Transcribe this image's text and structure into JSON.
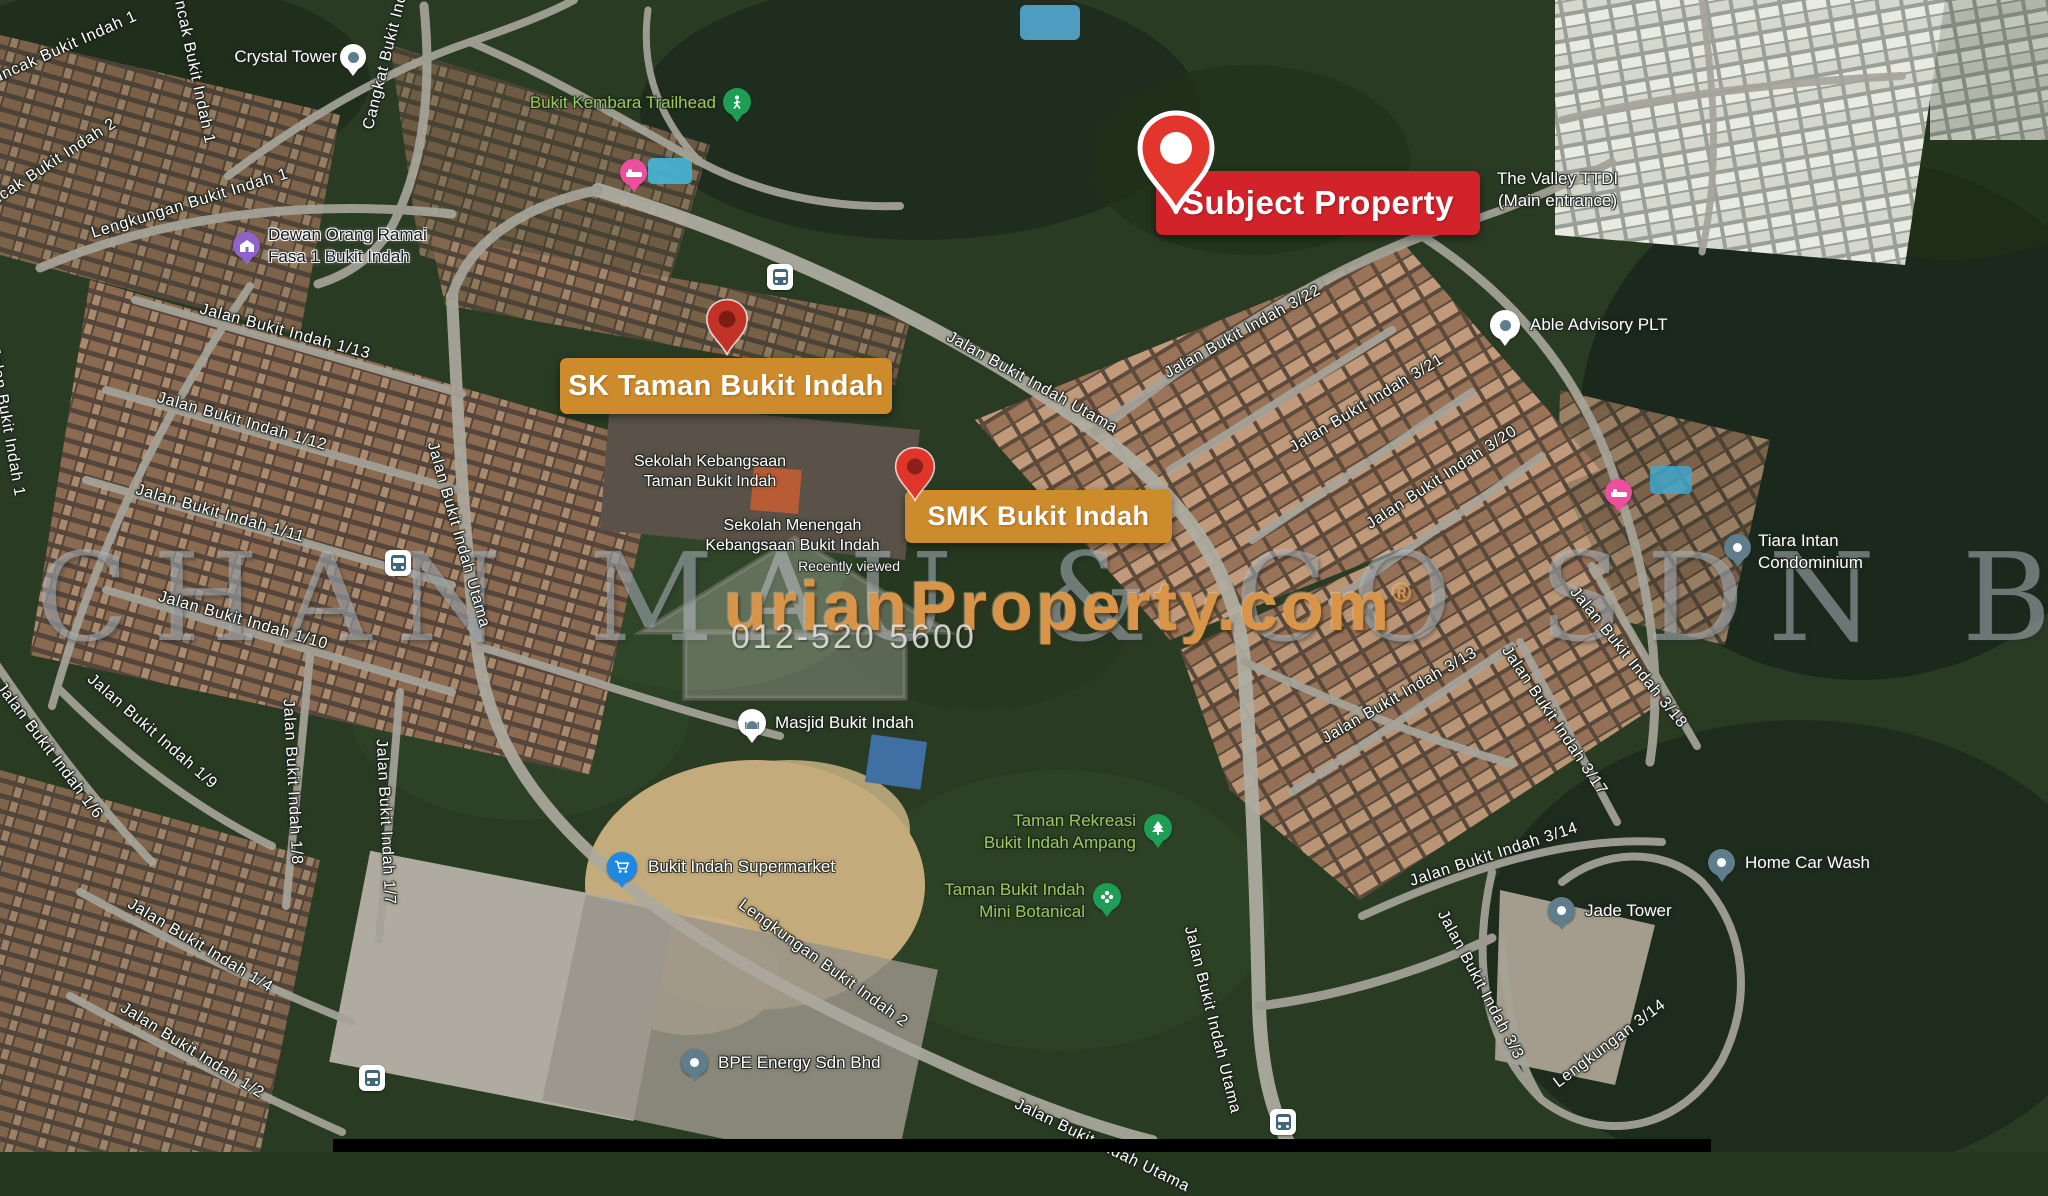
{
  "map": {
    "banners": {
      "subject": {
        "label": "Subject Property",
        "bg": "#d2222a"
      },
      "sk": {
        "label": "SK Taman Bukit Indah",
        "bg": "#ce8b2c"
      },
      "smk": {
        "label": "SMK Bukit Indah",
        "bg": "#ce8b2c"
      }
    },
    "places": {
      "crystal_tower": "Crystal Tower",
      "bukit_kembara_trailhead": "Bukit Kembara Trailhead",
      "dewan_line1": "Dewan Orang Ramai",
      "dewan_line2": "Fasa 1 Bukit Indah",
      "valley_line1": "The Valley TTDI",
      "valley_line2": "(Main entrance)",
      "able_advisory": "Able Advisory PLT",
      "tiara_line1": "Tiara Intan",
      "tiara_line2": "Condominium",
      "sk_school_line1": "Sekolah Kebangsaan",
      "sk_school_line2": "Taman Bukit Indah",
      "smk_school_line1": "Sekolah Menengah",
      "smk_school_line2": "Kebangsaan Bukit Indah",
      "smk_school_note": "Recently viewed",
      "masjid": "Masjid Bukit Indah",
      "supermarket": "Bukit Indah Supermarket",
      "bpe_energy": "BPE Energy Sdn Bhd",
      "rekreasi_line1": "Taman Rekreasi",
      "rekreasi_line2": "Bukit Indah Ampang",
      "botanical_line1": "Taman Bukit Indah",
      "botanical_line2": "Mini Botanical",
      "home_car_wash": "Home Car Wash",
      "jade_tower": "Jade Tower"
    },
    "streets": [
      {
        "label": "Puncak Bukit Indah 2"
      },
      {
        "label": "Puncak Bukit Indah 1"
      },
      {
        "label": "Cangkat Bukit Indah"
      },
      {
        "label": "Lengkungan Bukit Indah 1"
      },
      {
        "label": "Jalan Bukit Indah 1/13"
      },
      {
        "label": "Jalan Bukit Indah 1/12"
      },
      {
        "label": "Jalan Bukit Indah 1/11"
      },
      {
        "label": "Jalan Bukit Indah 1/10"
      },
      {
        "label": "Jalan Bukit Indah 1/9"
      },
      {
        "label": "Jalan Bukit Indah 1/6"
      },
      {
        "label": "Jalan Bukit Indah 1/8"
      },
      {
        "label": "Jalan Bukit Indah 1/7"
      },
      {
        "label": "Jalan Bukit Indah 1/4"
      },
      {
        "label": "Jalan Bukit Indah 1/2"
      },
      {
        "label": "Jalan Bukit Indah 1"
      },
      {
        "label": "Jalan Bukit Indah Utama"
      },
      {
        "label": "Jalan Bukit Indah Utama"
      },
      {
        "label": "Jalan Bukit Indah Utama"
      },
      {
        "label": "Jalan Bukit Indah 3/22"
      },
      {
        "label": "Jalan Bukit Indah 3/21"
      },
      {
        "label": "Jalan Bukit Indah 3/20"
      },
      {
        "label": "Jalan Bukit Indah 3/13"
      },
      {
        "label": "Jalan Bukit Indah 3/17"
      },
      {
        "label": "Jalan Bukit Indah 3/18"
      },
      {
        "label": "Jalan Bukit Indah 3/14"
      },
      {
        "label": "Lengkungan 3/14"
      },
      {
        "label": "Jalan Bukit Indah 3/3"
      },
      {
        "label": "Lengkungan Bukit Indah 2"
      },
      {
        "label": "Jalan Bukit Indah Utama"
      },
      {
        "label": "Puncak Bukit Indah 1"
      }
    ],
    "watermark": {
      "brand": "urianProperty.com",
      "registered": "®",
      "phone": "012-520 5600",
      "company": "NG CHAN MAU & CO SDN BHD"
    },
    "colors": {
      "banner_red": "#d2222a",
      "banner_orange": "#ce8b2c",
      "marker_red": "#e2362c",
      "green_label": "#9bc95d",
      "watermark_orange": "#d8954a"
    }
  }
}
